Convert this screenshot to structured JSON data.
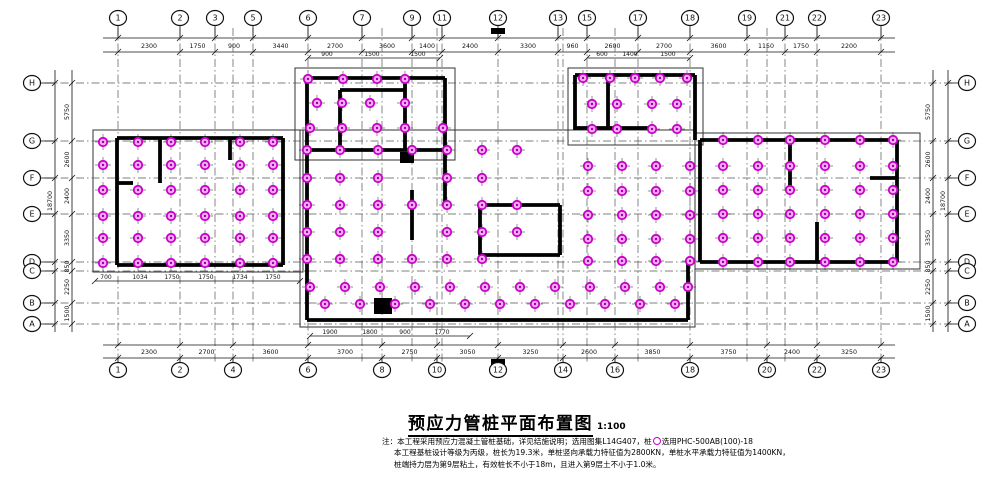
{
  "title": {
    "text": "预应力管桩平面布置图",
    "scale": "1:100"
  },
  "notes": {
    "line1_prefix": "注：本工程采用预应力混凝土管桩基础，详见结施说明；选用图集L14G407，桩",
    "line1_suffix": "选用PHC-500AB(100)-18",
    "line2": "本工程基桩设计等级为丙级，桩长为19.3米，单桩竖向承载力特征值为2800KN，单桩水平承载力特征值为1400KN，",
    "line3": "桩端持力层为第9层粘土，有效桩长不小于18m，且进入第9层土不小于1.0米。"
  },
  "plan": {
    "colors": {
      "line": "#111111",
      "wall": "#000000",
      "grid": "#555555",
      "pile_fill": "#f5aef5",
      "pile_stroke": "#c800c8",
      "pile_dot": "#a000a0"
    },
    "grid_v": [
      118,
      180,
      215,
      233,
      253,
      308,
      362,
      382,
      412,
      437,
      442,
      498,
      558,
      563,
      587,
      615,
      638,
      690,
      747,
      767,
      785,
      817,
      881
    ],
    "grid_h": [
      83,
      141,
      178,
      214,
      262,
      271,
      303,
      324
    ],
    "bubbles": {
      "top": [
        [
          "1",
          118
        ],
        [
          "2",
          180
        ],
        [
          "3",
          215
        ],
        [
          "5",
          253
        ],
        [
          "6",
          308
        ],
        [
          "7",
          362
        ],
        [
          "9",
          412
        ],
        [
          "11",
          442
        ],
        [
          "12",
          498
        ],
        [
          "13",
          558
        ],
        [
          "15",
          587
        ],
        [
          "17",
          638
        ],
        [
          "18",
          690
        ],
        [
          "19",
          747
        ],
        [
          "21",
          785
        ],
        [
          "22",
          817
        ],
        [
          "23",
          881
        ]
      ],
      "bottom": [
        [
          "1",
          118
        ],
        [
          "2",
          180
        ],
        [
          "4",
          233
        ],
        [
          "6",
          308
        ],
        [
          "8",
          382
        ],
        [
          "10",
          437
        ],
        [
          "12",
          498
        ],
        [
          "14",
          563
        ],
        [
          "16",
          615
        ],
        [
          "18",
          690
        ],
        [
          "20",
          767
        ],
        [
          "22",
          817
        ],
        [
          "23",
          881
        ]
      ],
      "left": [
        [
          "H",
          83
        ],
        [
          "G",
          141
        ],
        [
          "F",
          178
        ],
        [
          "E",
          214
        ],
        [
          "D",
          262
        ],
        [
          "C",
          271
        ],
        [
          "B",
          303
        ],
        [
          "A",
          324
        ]
      ],
      "right": [
        [
          "H",
          83
        ],
        [
          "G",
          141
        ],
        [
          "F",
          178
        ],
        [
          "E",
          214
        ],
        [
          "D",
          262
        ],
        [
          "C",
          271
        ],
        [
          "B",
          303
        ],
        [
          "A",
          324
        ]
      ]
    },
    "bands": {
      "top": {
        "y1": 38,
        "y2": 52,
        "x1": 103,
        "x2": 895,
        "text_y": 48,
        "stations": [
          118,
          180,
          215,
          253,
          308,
          362,
          412,
          442,
          498,
          558,
          587,
          638,
          690,
          747,
          785,
          817,
          881
        ],
        "values": [
          "2300",
          "1750",
          "900",
          "3440",
          "2700",
          "3600",
          "1400",
          "2400",
          "3300",
          "960",
          "2600",
          "2700",
          "3600",
          "1150",
          "1750",
          "2200"
        ]
      },
      "bottom": {
        "y1": 345,
        "y2": 358,
        "x1": 103,
        "x2": 895,
        "text_y": 354,
        "stations": [
          118,
          180,
          233,
          308,
          382,
          437,
          498,
          563,
          615,
          690,
          767,
          817,
          881
        ],
        "values": [
          "2300",
          "2700",
          "3600",
          "3700",
          "2750",
          "3050",
          "3250",
          "2600",
          "3850",
          "3750",
          "2400",
          "3250"
        ]
      },
      "left": {
        "x_seg": 72,
        "x_tot": 55,
        "y1": 70,
        "y2": 332,
        "stations": [
          83,
          141,
          178,
          214,
          262,
          271,
          303,
          324
        ],
        "seg_values": [
          "5750",
          "2600",
          "2400",
          "3350",
          "850",
          "2250",
          "1500"
        ],
        "total": "18700"
      },
      "right": {
        "x_seg": 933,
        "x_tot": 948,
        "y1": 70,
        "y2": 332,
        "stations": [
          83,
          141,
          178,
          214,
          262,
          271,
          303,
          324
        ],
        "seg_values": [
          "5750",
          "2600",
          "2400",
          "3350",
          "850",
          "2250",
          "1500"
        ],
        "total": "18700"
      }
    },
    "sub_dims": [
      {
        "line": [
          308,
          58,
          440
        ],
        "texts": [
          [
            327,
            56,
            "900"
          ],
          [
            372,
            56,
            "1500"
          ],
          [
            418,
            56,
            "1500"
          ]
        ]
      },
      {
        "line": [
          587,
          58,
          690
        ],
        "texts": [
          [
            602,
            56,
            "600"
          ],
          [
            630,
            56,
            "1400"
          ],
          [
            668,
            56,
            "1500"
          ]
        ]
      },
      {
        "line": [
          95,
          281,
          300
        ],
        "texts": [
          [
            106,
            279,
            "700"
          ],
          [
            140,
            279,
            "1034"
          ],
          [
            172,
            279,
            "1750"
          ],
          [
            206,
            279,
            "1750"
          ],
          [
            240,
            279,
            "1734"
          ],
          [
            273,
            279,
            "1750"
          ]
        ]
      },
      {
        "line": [
          310,
          336,
          470
        ],
        "texts": [
          [
            330,
            334,
            "1900"
          ],
          [
            370,
            334,
            "1800"
          ],
          [
            405,
            334,
            "900"
          ],
          [
            442,
            334,
            "1770"
          ]
        ]
      }
    ],
    "outlines": [
      [
        93,
        130,
        210,
        142
      ],
      [
        295,
        68,
        160,
        92
      ],
      [
        568,
        68,
        135,
        77
      ],
      [
        695,
        133,
        225,
        136
      ],
      [
        300,
        130,
        395,
        197
      ]
    ],
    "walls": [
      [
        117,
        138,
        283,
        138
      ],
      [
        283,
        138,
        283,
        265
      ],
      [
        117,
        265,
        283,
        265
      ],
      [
        117,
        138,
        117,
        265
      ],
      [
        160,
        138,
        160,
        183
      ],
      [
        230,
        138,
        230,
        160
      ],
      [
        117,
        183,
        133,
        183
      ],
      [
        307,
        78,
        307,
        320
      ],
      [
        307,
        78,
        445,
        78
      ],
      [
        445,
        78,
        445,
        160
      ],
      [
        340,
        90,
        405,
        90
      ],
      [
        340,
        90,
        340,
        150
      ],
      [
        405,
        78,
        405,
        150
      ],
      [
        307,
        150,
        445,
        150
      ],
      [
        575,
        75,
        695,
        75
      ],
      [
        575,
        75,
        575,
        130
      ],
      [
        695,
        75,
        695,
        140
      ],
      [
        608,
        75,
        608,
        128
      ],
      [
        575,
        128,
        650,
        128
      ],
      [
        700,
        140,
        897,
        140
      ],
      [
        897,
        140,
        897,
        262
      ],
      [
        700,
        262,
        897,
        262
      ],
      [
        700,
        140,
        700,
        262
      ],
      [
        790,
        140,
        790,
        188
      ],
      [
        817,
        222,
        817,
        262
      ],
      [
        870,
        178,
        897,
        178
      ],
      [
        307,
        320,
        688,
        320
      ],
      [
        688,
        262,
        688,
        320
      ],
      [
        412,
        190,
        412,
        240
      ],
      [
        445,
        160,
        445,
        205
      ],
      [
        480,
        205,
        560,
        205
      ],
      [
        560,
        205,
        560,
        255
      ],
      [
        480,
        255,
        560,
        255
      ],
      [
        480,
        205,
        480,
        255
      ]
    ],
    "solids": [
      [
        400,
        152,
        14,
        11
      ],
      [
        374,
        298,
        18,
        16
      ]
    ],
    "markers": [
      [
        491,
        28,
        14,
        6
      ],
      [
        491,
        359,
        14,
        6
      ]
    ],
    "pile_rows": [
      {
        "y": 142,
        "xs": [
          103,
          138,
          171,
          205,
          240,
          273
        ]
      },
      {
        "y": 165,
        "xs": [
          103,
          138,
          171,
          205,
          240,
          273
        ]
      },
      {
        "y": 190,
        "xs": [
          103,
          138,
          171,
          205,
          240,
          273
        ]
      },
      {
        "y": 216,
        "xs": [
          103,
          138,
          171,
          205,
          240,
          273
        ]
      },
      {
        "y": 238,
        "xs": [
          103,
          138,
          171,
          205,
          240,
          273
        ]
      },
      {
        "y": 263,
        "xs": [
          103,
          138,
          171,
          205,
          240,
          273
        ]
      },
      {
        "y": 79,
        "xs": [
          308,
          343,
          377,
          405
        ]
      },
      {
        "y": 103,
        "xs": [
          317,
          342,
          370,
          405
        ]
      },
      {
        "y": 128,
        "xs": [
          310,
          342,
          377,
          405,
          443
        ]
      },
      {
        "y": 78,
        "xs": [
          583,
          610,
          635,
          660,
          687
        ]
      },
      {
        "y": 104,
        "xs": [
          592,
          617,
          652,
          677
        ]
      },
      {
        "y": 129,
        "xs": [
          592,
          617,
          652,
          677
        ]
      },
      {
        "y": 150,
        "xs": [
          307,
          340,
          378,
          412,
          447,
          482,
          517
        ]
      },
      {
        "y": 166,
        "xs": [
          588,
          622,
          656,
          690
        ]
      },
      {
        "y": 178,
        "xs": [
          307,
          340,
          378,
          447,
          482
        ]
      },
      {
        "y": 191,
        "xs": [
          588,
          622,
          656,
          690
        ]
      },
      {
        "y": 205,
        "xs": [
          307,
          340,
          378,
          412,
          447,
          482,
          517
        ]
      },
      {
        "y": 215,
        "xs": [
          588,
          622,
          656,
          690
        ]
      },
      {
        "y": 232,
        "xs": [
          307,
          340,
          378,
          447,
          482,
          517
        ]
      },
      {
        "y": 239,
        "xs": [
          588,
          622,
          656,
          690
        ]
      },
      {
        "y": 259,
        "xs": [
          307,
          340,
          378,
          412,
          447,
          482
        ]
      },
      {
        "y": 261,
        "xs": [
          588,
          622,
          656,
          690
        ]
      },
      {
        "y": 287,
        "xs": [
          310,
          345,
          380,
          415,
          450,
          485,
          520,
          555,
          590,
          625,
          660,
          688
        ]
      },
      {
        "y": 304,
        "xs": [
          325,
          360,
          395,
          430,
          465,
          500,
          535,
          570,
          605,
          640,
          675
        ]
      },
      {
        "y": 140,
        "xs": [
          723,
          758,
          790,
          825,
          860,
          893
        ]
      },
      {
        "y": 166,
        "xs": [
          723,
          758,
          790,
          825,
          860,
          893
        ]
      },
      {
        "y": 190,
        "xs": [
          723,
          758,
          790,
          825,
          860,
          893
        ]
      },
      {
        "y": 214,
        "xs": [
          723,
          758,
          790,
          825,
          860,
          893
        ]
      },
      {
        "y": 238,
        "xs": [
          723,
          758,
          790,
          825,
          860,
          893
        ]
      },
      {
        "y": 262,
        "xs": [
          723,
          758,
          790,
          825,
          860,
          893
        ]
      }
    ]
  }
}
